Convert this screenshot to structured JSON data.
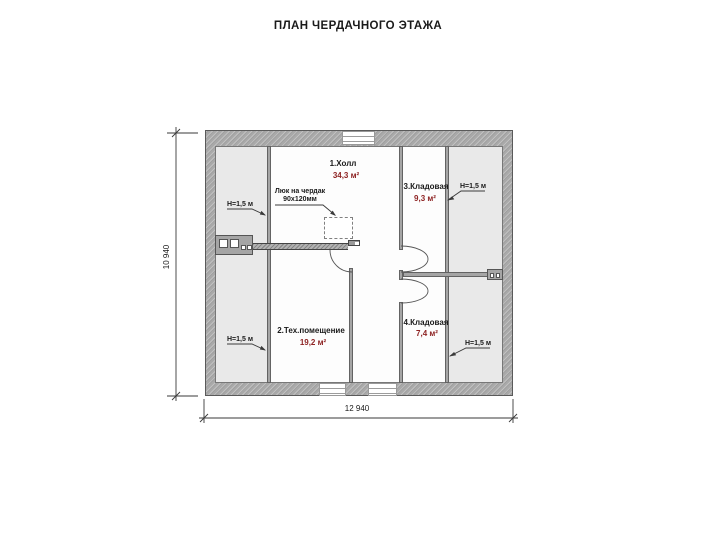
{
  "title": "ПЛАН ЧЕРДАЧНОГО ЭТАЖА",
  "rooms": [
    {
      "name": "1.Холл",
      "area": "34,3 м²"
    },
    {
      "name": "2.Тех.помещение",
      "area": "19,2 м²"
    },
    {
      "name": "3.Кладовая",
      "area": "9,3 м²"
    },
    {
      "name": "4.Кладовая",
      "area": "7,4 м²"
    }
  ],
  "labels": {
    "attic_hatch_line1": "Люк на чердак",
    "attic_hatch_line2": "90х120мм",
    "height_top_left": "H=1,5 м",
    "height_bottom_left": "H=1,5 м",
    "height_top_right": "H=1,5 м",
    "height_bottom_right": "H=1,5 м"
  },
  "dimensions": {
    "overall_width": "12 940",
    "overall_height": "10 940"
  },
  "colors": {
    "wall": "#a9a9a9",
    "strip": "#e9e9e9",
    "area-red": "#8e2323",
    "line": "#3a3a3a"
  }
}
